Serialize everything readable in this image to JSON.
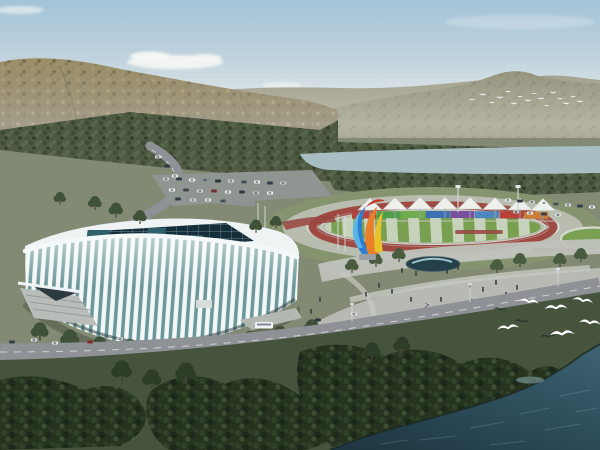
{
  "scene": {
    "title": "Aerial architectural rendering of a sports complex",
    "description": "High-angle rendering of a white ribbed indoor arena beside an outdoor running-track stadium with canopy tents and a colorful sculpture, set against tree-covered mountains, a river, plazas with pedestrians, dark foreground woods and a lake with flying gulls.",
    "landmarks": {
      "arena": "white ribbed gymnasium with dark glass skylight roof",
      "stadium": "red oval running track with striped green infield",
      "sculpture": "twisting blue-orange-yellow flame sculpture",
      "river": "gray-teal river band below the mountains",
      "lake": "dark teal water in bottom-right corner"
    },
    "counts": {
      "canopy_tents": 8,
      "billboard_panels": 8,
      "foreground_gulls": 6,
      "dark_silhouette_birds": 3,
      "distant_bird_flock": 16
    }
  },
  "colors": {
    "sky_top": "#a3c3d8",
    "sky_mid": "#c9d8df",
    "sky_horizon": "#e8eae6",
    "cloud": "#f4f6f4",
    "mountain_far": "#9b9a84",
    "mountain_right": "#8f8e77",
    "hill_top": "#9c8e66",
    "hill_bottom": "#655f45",
    "forest_band": "#4d5840",
    "river": "#a9bec2",
    "plain": "#828a74",
    "road": "#8e9296",
    "road_marking": "#eceeea",
    "track_red": "#9e4a42",
    "infield_green": "#78a050",
    "infield_stripe": "#c7d2ba",
    "tent_white": "#eef0ec",
    "arena_white": "#eef3f4",
    "arena_rib": "#f3f7f8",
    "arena_glass": "#6d989a",
    "skylight_dark": "#152e3a",
    "plaza_light": "#b7bab3",
    "pool_dark": "#24404a",
    "sculpture_blue": "#2a7fd4",
    "sculpture_orange": "#e8802a",
    "sculpture_yellow": "#e8c22a",
    "sculpture_red": "#c03a2a",
    "lawn_dark": "#46543d",
    "forest_dark": "#26341f",
    "water_light": "#3c6170",
    "water_dark": "#1e3742",
    "bird_white": "#ffffff",
    "people_dark": "#363d42",
    "billboards": [
      "#b5413a",
      "#4f9e4c",
      "#6fae4e",
      "#3f6fb5",
      "#7a4fa0",
      "#4f86c0",
      "#b5413a",
      "#c97f3a"
    ]
  }
}
